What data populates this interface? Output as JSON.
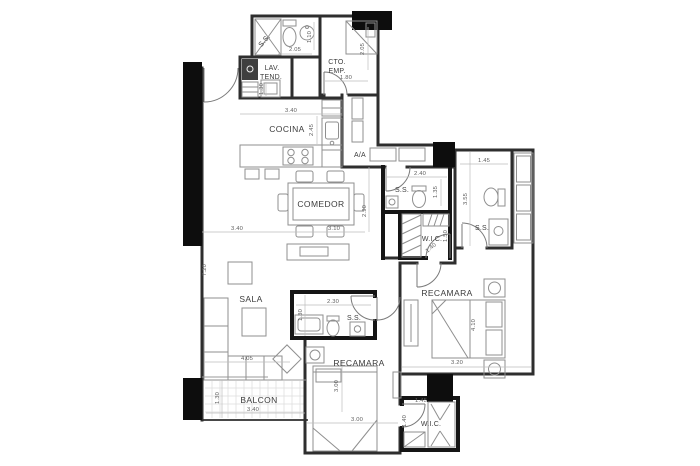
{
  "colors": {
    "wall": "#2e2e2e",
    "bath_wall": "#151515",
    "column": "#0d0d0d",
    "furniture": "#8f8f8f",
    "dim_line": "#bdbdbd",
    "dim_text": "#5e5e5e",
    "label_text": "#3c3c3c",
    "balcony_grid": "#dedede"
  },
  "rooms": {
    "ss_top": "S.S.",
    "lav_line1": "LAV.",
    "lav_line2": "TEND.",
    "cto_line1": "CTO.",
    "cto_line2": "EMP.",
    "cocina": "COCINA",
    "aa": "A/A",
    "comedor": "COMEDOR",
    "ss_hall": "S.S.",
    "wic_upper": "W.I.C.",
    "ss_master": "S.S.",
    "recamara_master": "RECAMARA",
    "sala": "SALA",
    "ss_middle": "S.S.",
    "recamara_2": "RECAMARA",
    "balcon": "BALCON",
    "wic_lower": "W.I.C."
  },
  "dims": {
    "ss_top_w": "2.05",
    "ss_top_d": "1.10",
    "cto_w": "1.80",
    "cto_h": "2.05",
    "lav_d": "1.30",
    "cocina_w": "3.40",
    "cocina_d": "2.45",
    "hall_ss_w": "2.40",
    "hall_ss_d": "1.35",
    "master_ss_w": "1.45",
    "master_ss_h": "3.55",
    "wic_upper_d": "1.50",
    "wic_upper_door": "1.40",
    "comedor_h": "2.90",
    "sala_w": "3.40",
    "comedor_w": "3.10",
    "sala_h": "7.20",
    "sala_l": "4.05",
    "mid_ss_w": "2.30",
    "mid_ss_d": "1.30",
    "rec2_h": "3.00",
    "rec2_w": "3.00",
    "master_bed_l": "4.10",
    "master_w": "3.20",
    "balcon_d": "1.30",
    "balcon_w": "3.40",
    "wic_lower_door": "1.45",
    "wic_lower_d": "1.40"
  }
}
